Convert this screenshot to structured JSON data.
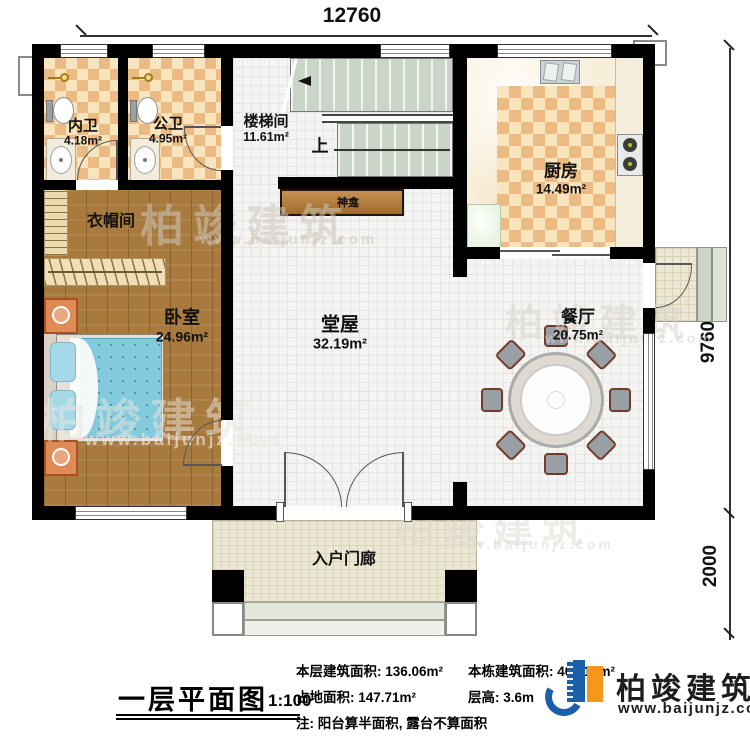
{
  "title": {
    "name_cn": "一层平面图",
    "scale": "1:100"
  },
  "dimensions": {
    "width_top": "12760",
    "height_main": "9760",
    "height_porch": "2000"
  },
  "rooms": {
    "neiwei": {
      "name": "内卫",
      "area": "4.18m²"
    },
    "gongwei": {
      "name": "公卫",
      "area": "4.95m²"
    },
    "stairwell": {
      "name": "楼梯间",
      "area": "11.61m²"
    },
    "kitchen": {
      "name": "厨房",
      "area": "14.49m²"
    },
    "cloakroom": {
      "name": "衣帽间"
    },
    "bedroom": {
      "name": "卧室",
      "area": "24.96m²"
    },
    "hall": {
      "name": "堂屋",
      "area": "32.19m²"
    },
    "dining": {
      "name": "餐厅",
      "area": "20.75m²"
    },
    "porch": {
      "name": "入户门廊"
    }
  },
  "annotations": {
    "shrine": "神龛",
    "stairs_up": "上"
  },
  "stats": {
    "floor_area": "本层建筑面积: 136.06m²",
    "total_area": "本栋建筑面积: 408.18m²",
    "land_area": "占地面积: 147.71m²",
    "floor_height": "层高: 3.6m",
    "note": "注: 阳台算半面积, 露台不算面积"
  },
  "brand": {
    "name": "柏竣建筑",
    "website": "www.baijunjz.com"
  },
  "colors": {
    "wall": "#000000",
    "brand_blue": "#1b5fa8",
    "brand_orange": "#f5971d"
  }
}
